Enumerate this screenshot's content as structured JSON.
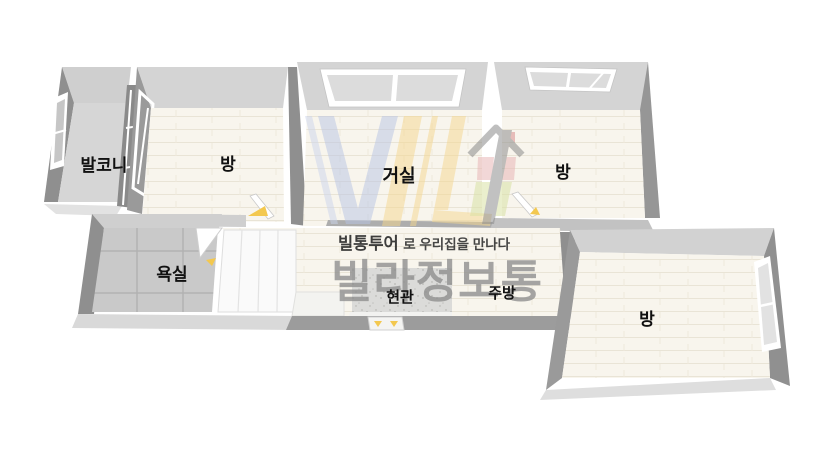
{
  "rooms": {
    "balcony": {
      "label": "발코니"
    },
    "room1": {
      "label": "방"
    },
    "living": {
      "label": "거실"
    },
    "room2": {
      "label": "방"
    },
    "bathroom": {
      "label": "욕실"
    },
    "entrance": {
      "label": "현관"
    },
    "kitchen": {
      "label": "주방"
    },
    "room3": {
      "label": "방"
    }
  },
  "watermark": {
    "slogan_bold": "빌통투어",
    "slogan_rest": "로 우리집을 만나다",
    "brand": "빌라정보통"
  },
  "colors": {
    "background": "#ffffff",
    "wall_top": "#d4d4d4",
    "wall_face": "#8f8f8f",
    "floor_wood": "#f8f5ed",
    "floor_tile": "#c9c9c9",
    "balcony_floor": "#d6d6d6",
    "entrance_floor": "#dbdbd9",
    "door_accent": "#f3c84f",
    "logo_blue": "#b8c4e4",
    "logo_yellow": "#f5d78e",
    "logo_red": "#e8b7b7",
    "logo_green": "#d9e2a5",
    "brand_gray": "#8d8d8d"
  }
}
